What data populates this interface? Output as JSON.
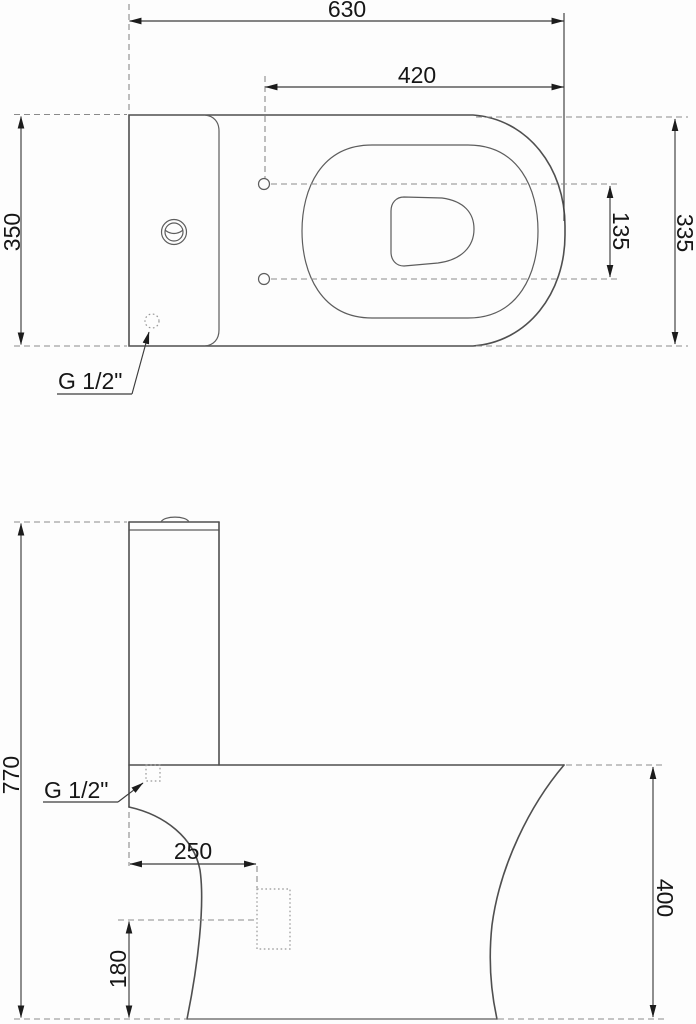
{
  "drawing": {
    "type": "technical-dimension-drawing",
    "subject": "close-coupled toilet (WC) with cistern",
    "units_implied": "mm",
    "colors": {
      "background": "#fdfdfd",
      "outline": "#4f4f4f",
      "dimension_line": "#3c3c3c",
      "extension_dashed": "#8a8a8a",
      "text": "#161616",
      "arrow": "#1c1c1c"
    },
    "top_view": {
      "dims": {
        "total_depth": "630",
        "bowl_depth": "420",
        "tank_width": "350",
        "bowl_width": "335",
        "hinge_spacing": "135",
        "water_inlet": "G 1/2\""
      }
    },
    "side_view": {
      "dims": {
        "total_height": "770",
        "bowl_height": "400",
        "outlet_distance": "250",
        "outlet_height": "180",
        "water_inlet": "G 1/2\""
      }
    }
  }
}
